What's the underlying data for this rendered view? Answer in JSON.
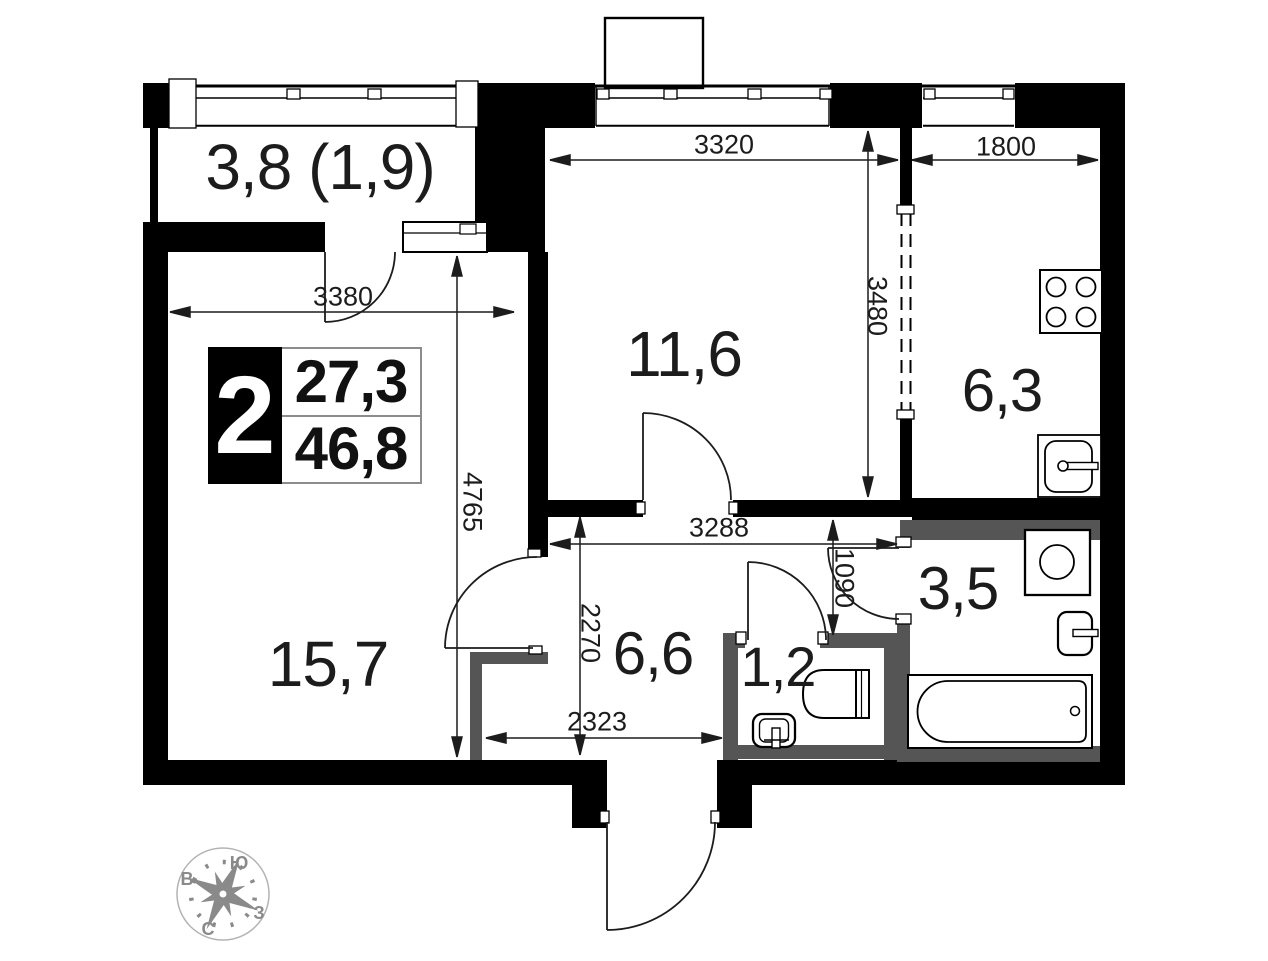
{
  "badge": {
    "rooms": "2",
    "living_area": "27,3",
    "total_area": "46,8"
  },
  "rooms": {
    "balcony": "3,8 (1,9)",
    "bedroom": "11,6",
    "kitchen": "6,3",
    "living": "15,7",
    "hallway": "6,6",
    "wc": "1,2",
    "bathroom": "3,5"
  },
  "dimensions": {
    "bedroom_width": "3320",
    "kitchen_width": "1800",
    "bedroom_depth": "3480",
    "living_width": "3380",
    "living_depth": "4765",
    "hallway_width": "3288",
    "bath_entry": "1090",
    "hallway_depth": "2270",
    "hallway_lower_width": "2323"
  },
  "compass": {
    "north": "С",
    "south": "Ю",
    "east": "В",
    "west": "З"
  },
  "colors": {
    "wall": "#000000",
    "wet_wall": "#555555",
    "line": "#1c1c1c",
    "compass": "#8a8a8a"
  }
}
